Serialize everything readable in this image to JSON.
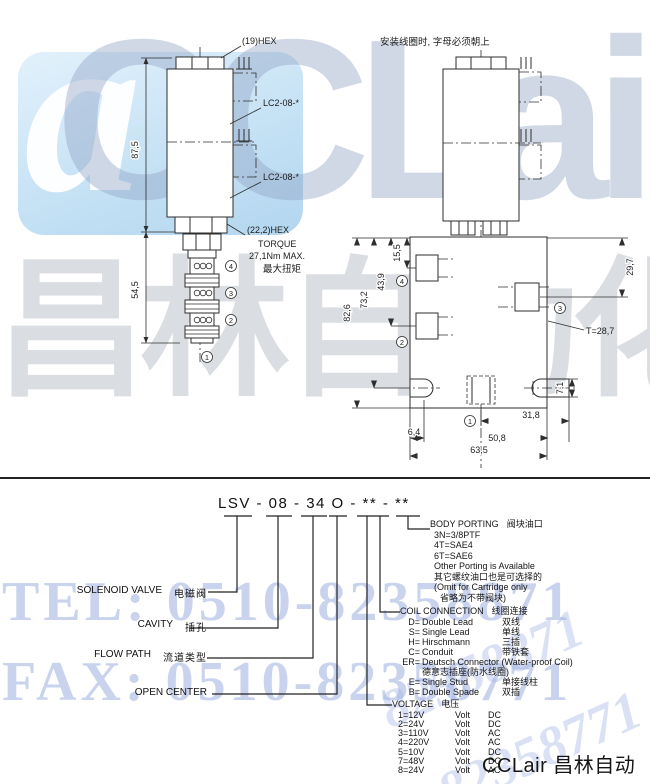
{
  "watermark": {
    "logo_letters": "CCLair",
    "logo_mark": "a",
    "brand_cn": "昌林自动化",
    "tel": "TEL: 0510-82358871",
    "fax": "FAX: 0510-82358771",
    "diag_tel": "82358871",
    "diag_fax": "82358771",
    "accent": "#b6c3e8",
    "tile_blue": "#bfe0f5"
  },
  "footer": {
    "brand": "CCLair 昌林自动化"
  },
  "left_drawing": {
    "hex_label": "(19)HEX",
    "coil_label_1": "LC2-08-*",
    "coil_label_2": "LC2-08-*",
    "hex2_label": "(22,2)HEX",
    "torque_1": "TORQUE",
    "torque_2": "27,1Nm MAX.",
    "torque_3": "最大扭矩",
    "dim_overall": "87,5",
    "dim_cartridge": "54,5",
    "port_4": "4",
    "port_3": "3",
    "port_2": "2",
    "port_1": "1"
  },
  "right_drawing": {
    "note": "安装线圈时, 字母必须朝上",
    "dim_height_overall": "82,6",
    "dim_height_2": "73,2",
    "dim_height_3": "43,9",
    "dim_height_4": "15,5",
    "dim_right": "29,7",
    "thickness": "T=28,7",
    "dim_slot": "7,1",
    "dim_offset": "6,4",
    "dim_bottom_1": "31,8",
    "dim_bottom_2": "50,8",
    "dim_bottom_3": "63,5",
    "port_4": "4",
    "port_3": "3",
    "port_2": "2",
    "port_1": "1"
  },
  "model_code": {
    "code": "LSV - 08 - 34 O - ** - **"
  },
  "left_labels": {
    "solenoid_en": "SOLENOID VALVE",
    "solenoid_cn": "电磁阀",
    "cavity_en": "CAVITY",
    "cavity_cn": "插孔",
    "flow_en": "FLOW PATH",
    "flow_cn": "流道类型",
    "open_center_en": "OPEN CENTER"
  },
  "body_porting": {
    "title_en": "BODY PORTING",
    "title_cn": "阀块油口",
    "l1": "3N=3/8PTF",
    "l2": "4T=SAE4",
    "l3": "6T=SAE6",
    "l4": "Other Porting is Available",
    "l5": "其它螺纹油口也是可选择的",
    "l6": "(Omit for Cartridge only",
    "l7": "省略为不带阀块)"
  },
  "coil_connection": {
    "title_en": "COIL CONNECTION",
    "title_cn": "线圈连接",
    "items": [
      {
        "code": "D=",
        "en": "Double Lead",
        "cn": "双线"
      },
      {
        "code": "S=",
        "en": "Single Lead",
        "cn": "单线"
      },
      {
        "code": "H=",
        "en": "Hirschmann",
        "cn": "三插"
      },
      {
        "code": "C=",
        "en": "Conduit",
        "cn": "带铁套"
      },
      {
        "code": "ER=",
        "en": "Deutsch Connector (Water-proof Coil)",
        "cn": ""
      },
      {
        "code": "",
        "en": "德意志插座(防水线圈)",
        "cn": ""
      },
      {
        "code": "E=",
        "en": "Single Stud",
        "cn": "单接线柱"
      },
      {
        "code": "B=",
        "en": "Double Spade",
        "cn": "双插"
      }
    ]
  },
  "voltage": {
    "title_en": "VOLTAGE",
    "title_cn": "电压",
    "items": [
      {
        "code": "1=12V",
        "unit": "Volt",
        "type": "DC"
      },
      {
        "code": "2=24V",
        "unit": "Volt",
        "type": "DC"
      },
      {
        "code": "3=110V",
        "unit": "Volt",
        "type": "AC"
      },
      {
        "code": "4=220V",
        "unit": "Volt",
        "type": "AC"
      },
      {
        "code": "5=10V",
        "unit": "Volt",
        "type": "DC"
      },
      {
        "code": "7=48V",
        "unit": "Volt",
        "type": "DC"
      },
      {
        "code": "8=24V",
        "unit": "Volt",
        "type": "AC"
      }
    ]
  }
}
